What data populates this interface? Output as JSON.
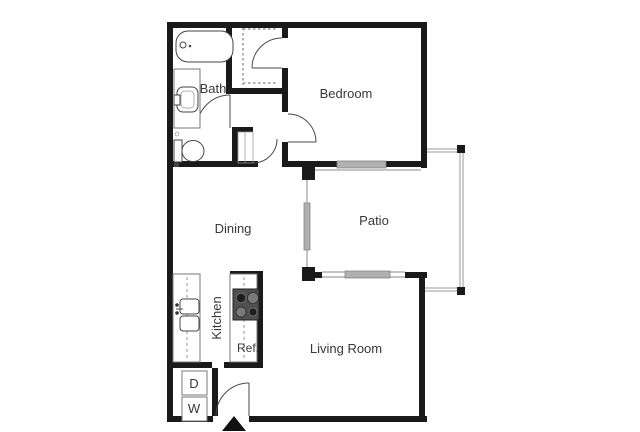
{
  "image_type": "apartment-floor-plan",
  "rooms": {
    "bath": {
      "label": "Bath"
    },
    "bedroom": {
      "label": "Bedroom"
    },
    "dining": {
      "label": "Dining"
    },
    "patio": {
      "label": "Patio"
    },
    "living_room": {
      "label": "Living Room"
    },
    "kitchen": {
      "label": "Kitchen"
    }
  },
  "appliances": {
    "refrigerator": {
      "label": "Ref."
    },
    "dryer": {
      "label": "D"
    },
    "washer": {
      "label": "W"
    }
  },
  "colors": {
    "background": "#ffffff",
    "wall": "#1a1a1a",
    "fixture_line": "#4a4a4a",
    "counter_line": "#777777",
    "dash": "#999999",
    "window_fill": "#b0b0b0",
    "railing": "#9a9a9a",
    "stove_body": "#4f4f4f",
    "burner_dark": "#1e1e1e",
    "burner_light": "#7a7a7a",
    "text": "#383838"
  }
}
